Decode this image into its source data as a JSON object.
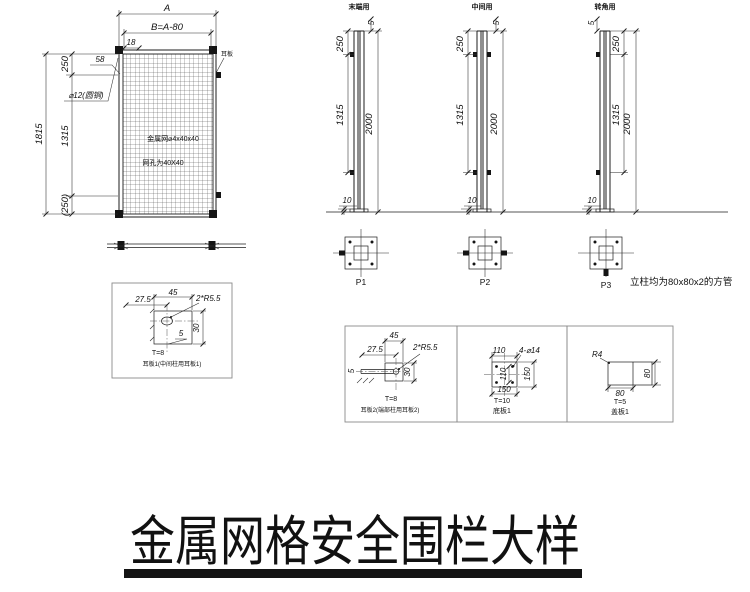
{
  "drawing_title": "金属网格安全围栏大样",
  "panel": {
    "dim_a": "A",
    "dim_b": "B=A-80",
    "dim_18": "18",
    "dim_58": "58",
    "dim_total_h": "1815",
    "dim_top": "250",
    "dim_mid": "1315",
    "dim_bottom": "(250)",
    "bar_label": "⌀12(圆钢)",
    "ear_label": "耳板",
    "mesh_note_1": "金属网⌀4x40x40",
    "mesh_note_2": "网孔为40X40"
  },
  "posts": [
    {
      "usage": "末端用",
      "dim_offset_top": "5",
      "dim_upper": "250",
      "dim_lower": "1315",
      "dim_total": "2000",
      "dim_plate": "10",
      "plate_label": "P1"
    },
    {
      "usage": "中间用",
      "dim_offset_top": "5",
      "dim_upper": "250",
      "dim_lower": "1315",
      "dim_total": "2000",
      "dim_plate": "10",
      "plate_label": "P2"
    },
    {
      "usage": "转角用",
      "dim_offset_top": "5",
      "dim_upper": "250",
      "dim_lower": "1315",
      "dim_total": "2000",
      "dim_plate": "10",
      "plate_label": "P3"
    }
  ],
  "post_note": "立柱均为80x80x2的方管",
  "details": {
    "ear1": {
      "dim_w": "45",
      "dim_offset": "27.5",
      "hole": "2*R5.5",
      "dim_h": "30",
      "dim_gap": "5",
      "thickness": "T=8",
      "caption": "耳板1(中间柱用耳板1)"
    },
    "ear2": {
      "dim_w": "45",
      "dim_offset": "27.5",
      "hole": "2*R5.5",
      "dim_h": "30",
      "dim_gap": "5",
      "thickness": "T=8",
      "caption": "耳板2(端部柱用耳板2)"
    },
    "base": {
      "dim_spacing": "110",
      "holes": "4-⌀14",
      "dim_inner": "110",
      "dim_h": "150",
      "dim_w": "150",
      "thickness": "T=10",
      "caption": "底板1"
    },
    "cap": {
      "radius": "R4",
      "dim_h": "80",
      "dim_w": "80",
      "thickness": "T=5",
      "caption": "盖板1"
    }
  }
}
